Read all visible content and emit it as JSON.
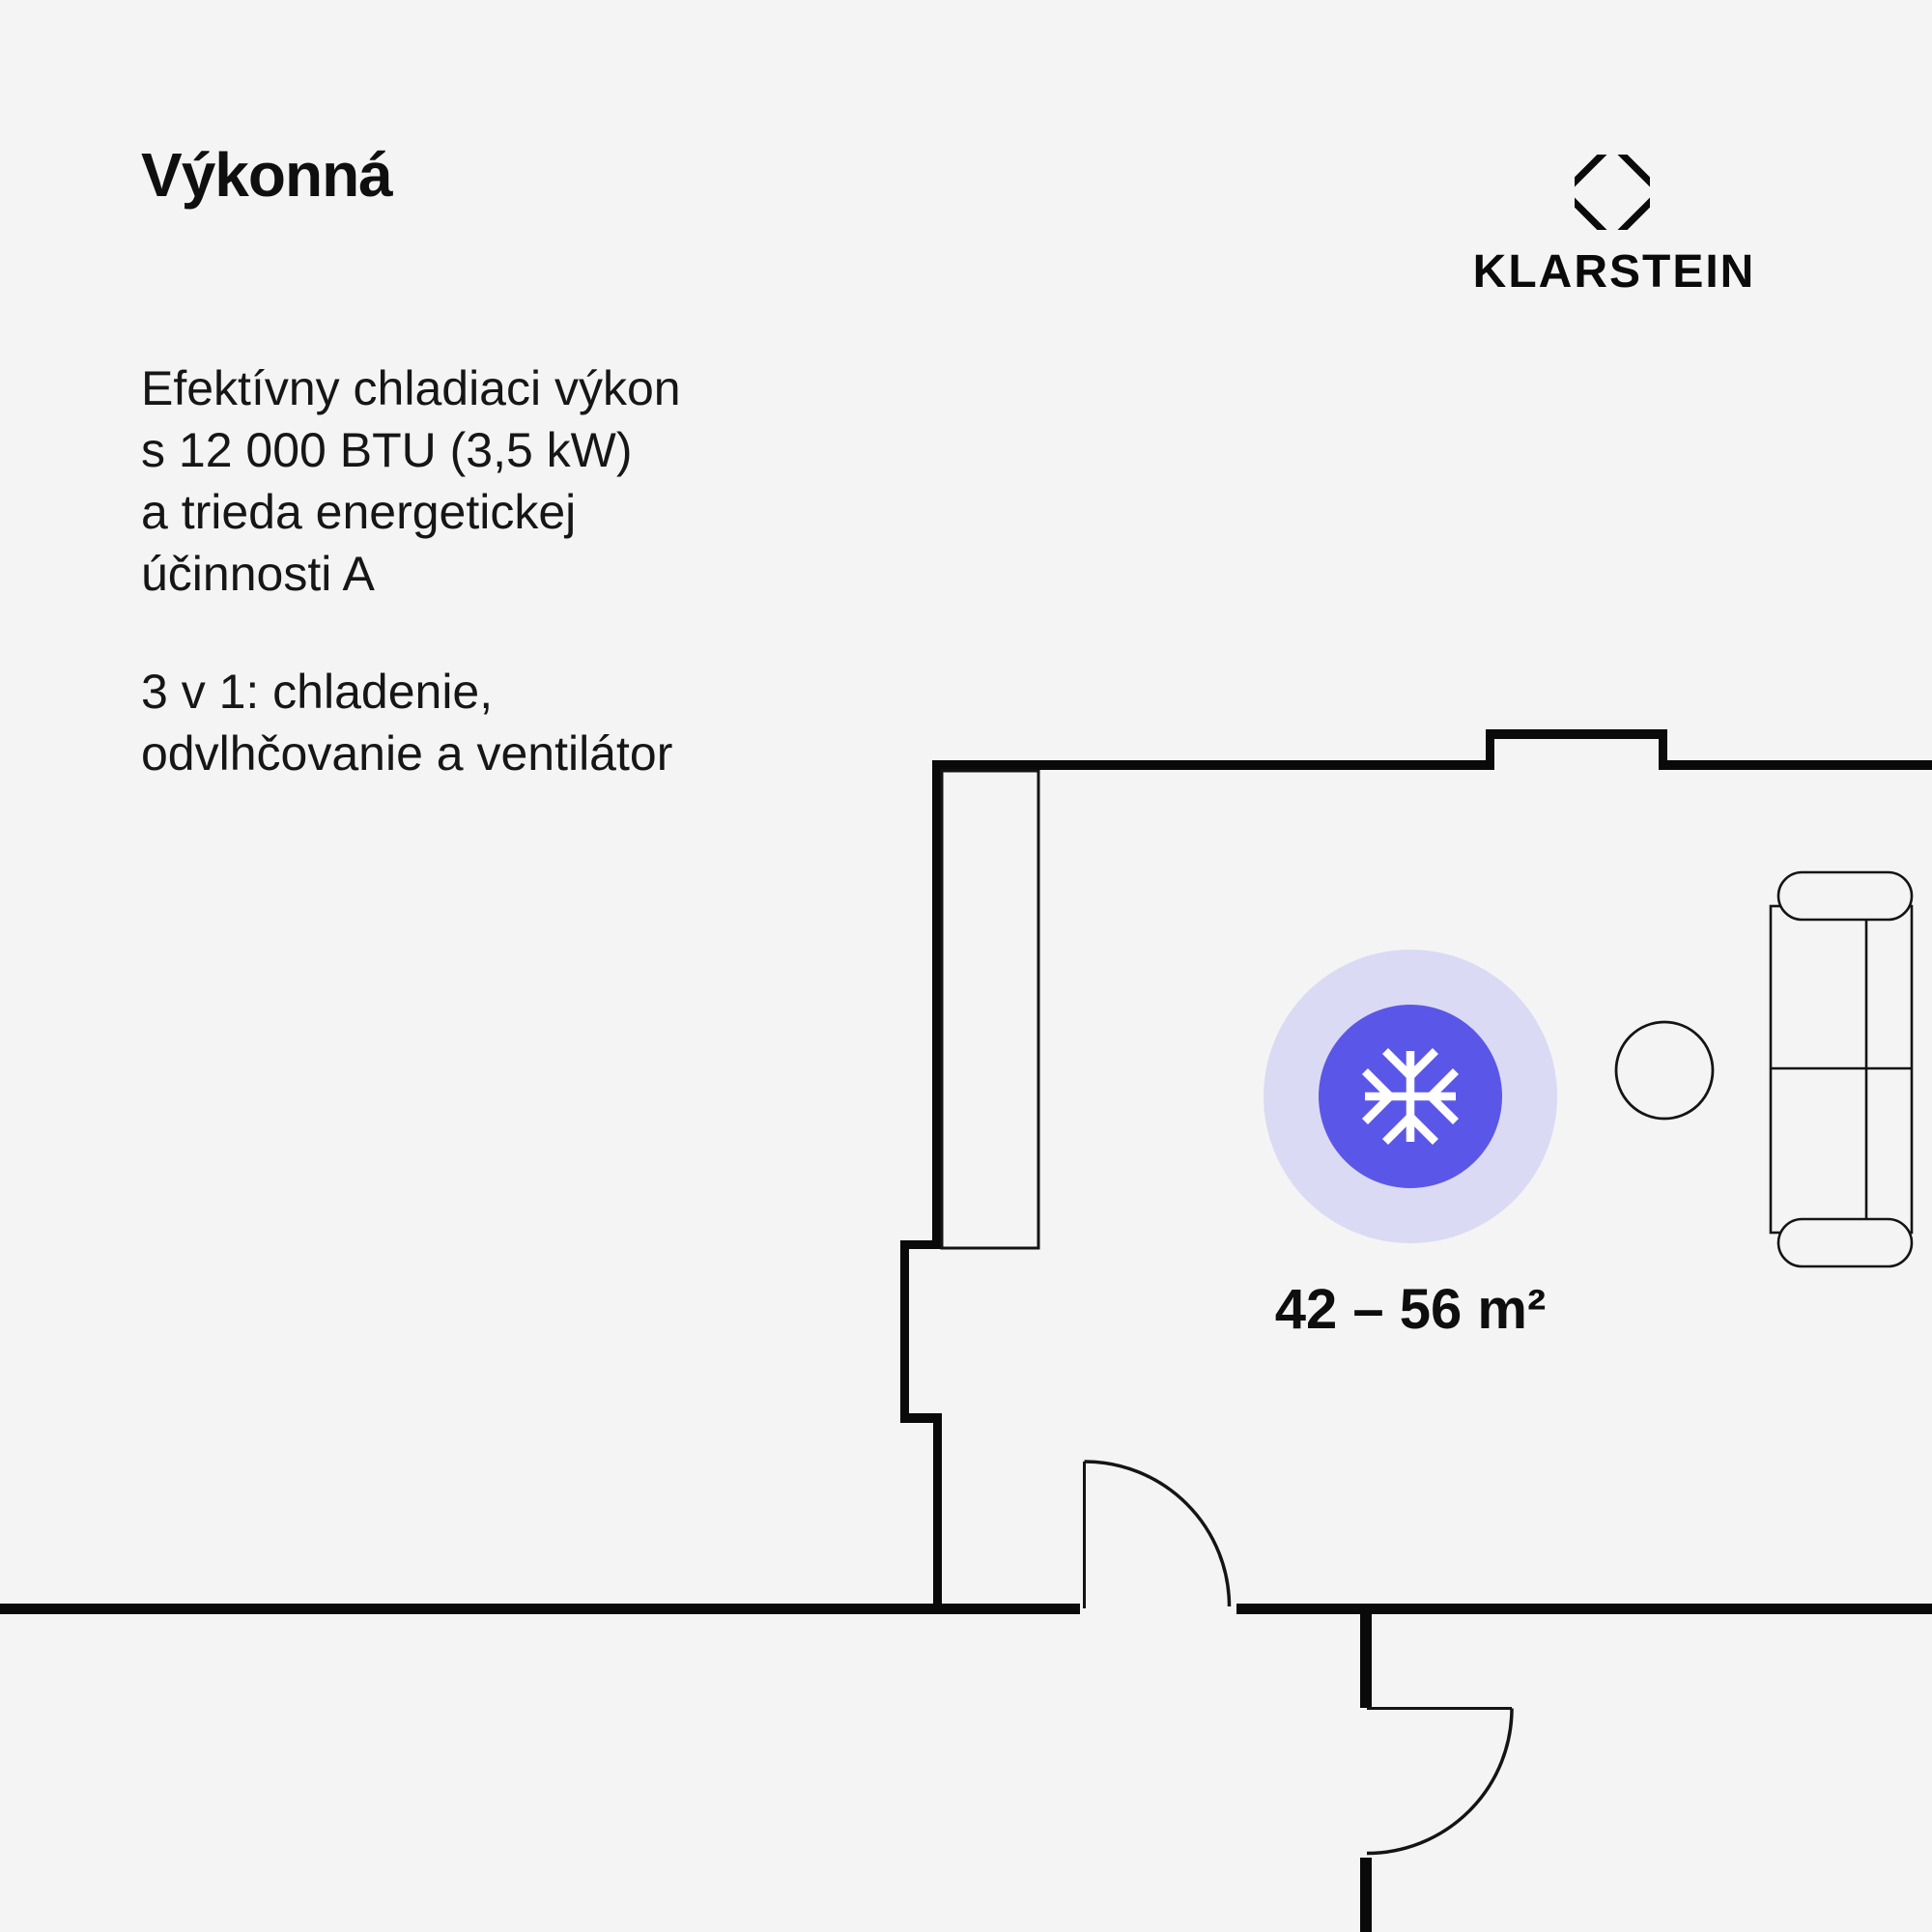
{
  "page": {
    "background_color": "#f5f4f5",
    "wall_color": "#0a0a0a",
    "line_color": "#141414"
  },
  "header": {
    "title": "Výkonná"
  },
  "paragraphs": {
    "p1_lines": [
      "Efektívny chladiaci výkon",
      "s 12 000 BTU (3,5 kW)",
      "a trieda energetickej",
      "účinnosti A"
    ],
    "p2_lines": [
      "3 v 1: chladenie,",
      "odvlhčovanie a ventilátor"
    ]
  },
  "brand": {
    "name": "KLARSTEIN",
    "logo_icon": "octagon-diamond",
    "color": "#0a0a0a"
  },
  "floorplan": {
    "area_label": "42 – 56 m²",
    "badge": {
      "icon": "snowflake-icon",
      "outer_ring_color": "#dbdaf4",
      "inner_circle_color": "#5a57e8",
      "icon_color": "#ffffff"
    },
    "furniture": [
      "closet",
      "sofa",
      "round-table"
    ],
    "door_count": 2
  }
}
